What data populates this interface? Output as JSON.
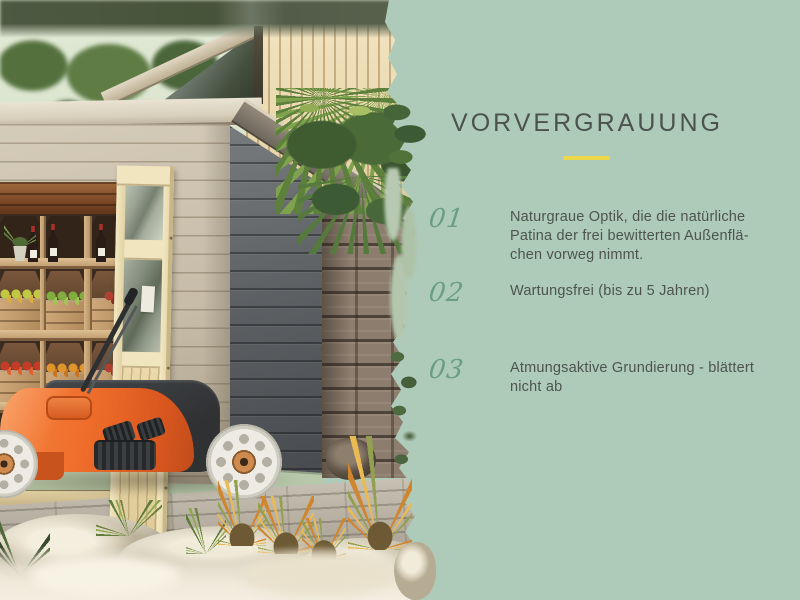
{
  "panel": {
    "title": "VORVERGRAUUNG",
    "items": [
      {
        "number": "01",
        "lines": [
          "Naturgraue Optik, die die natürliche",
          "Patina der frei bewitterten Außenflä-",
          "chen vorweg nimmt."
        ]
      },
      {
        "number": "02",
        "lines": [
          "Wartungsfrei (bis zu 5 Jahren)"
        ]
      },
      {
        "number": "03",
        "lines": [
          "Atmungsaktive Grundierung - blättert",
          "nicht ab"
        ]
      }
    ],
    "colors": {
      "background": "#aecbba",
      "title": "#4c524d",
      "number": "#6a9e82",
      "text": "#4d544e",
      "divider": "#ebd94b"
    }
  },
  "photo": {
    "subject": "Garden shed with pre-greyed cladding, open glazed wooden door, fruit-crate shelving and an orange lawn mower",
    "elements": [
      "trees",
      "skylight-window",
      "roof-fascia",
      "vertical-slat-wall",
      "hanging-ferns",
      "natural-stone-wall",
      "grey-plank-side-wall",
      "light-plank-front-wall",
      "storage-shelves",
      "wine-bottles",
      "potted-plant",
      "fruit-crates",
      "glazed-door",
      "orange-lawn-mower",
      "wooden-deck",
      "boulders",
      "ornamental-grasses"
    ]
  }
}
